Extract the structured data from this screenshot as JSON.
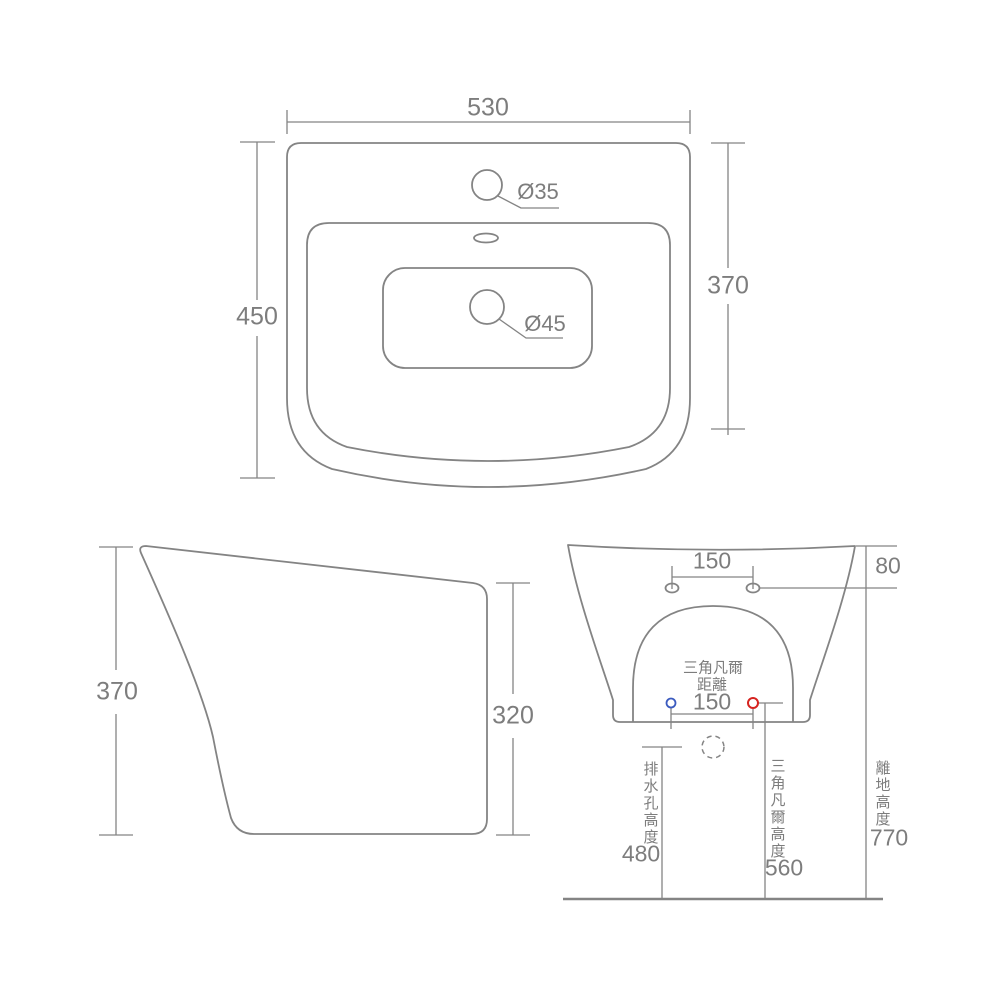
{
  "colors": {
    "line": "#848484",
    "text": "#7d7d7d",
    "cold_valve_accent": "#3b5bbf",
    "hot_valve_accent": "#d62420"
  },
  "top_view": {
    "width": "530",
    "overall_depth": "450",
    "basin_depth": "370",
    "faucet_hole_diameter": "Ø35",
    "drain_hole_diameter": "Ø45"
  },
  "side_view": {
    "front_height": "370",
    "back_height": "320"
  },
  "front_view": {
    "mounting_hole_spacing": "150",
    "mounting_hole_drop": "80",
    "valve_label_line1": "三角凡爾",
    "valve_label_line2": "距離",
    "valve_spacing": "150",
    "drain_height_caption": "排水孔高度",
    "drain_height": "480",
    "valve_height_caption": "三角凡爾高度",
    "valve_height": "560",
    "floor_clearance_caption": "離地高度",
    "floor_clearance": "770"
  }
}
